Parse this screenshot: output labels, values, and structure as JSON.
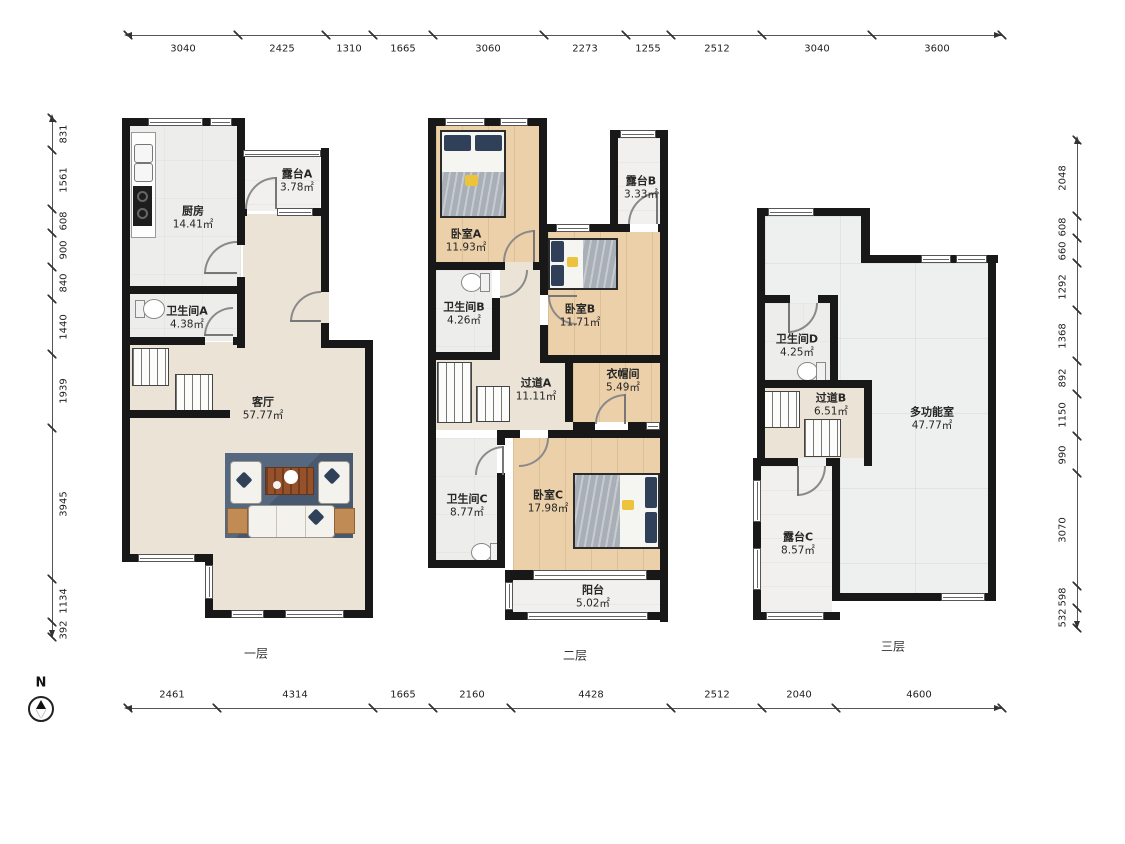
{
  "compass": {
    "north_label": "N"
  },
  "floors": [
    {
      "label": "一层",
      "rooms": [
        {
          "name": "厨房",
          "area": "14.41㎡"
        },
        {
          "name": "露台A",
          "area": "3.78㎡"
        },
        {
          "name": "卫生间A",
          "area": "4.38㎡"
        },
        {
          "name": "客厅",
          "area": "57.77㎡"
        }
      ]
    },
    {
      "label": "二层",
      "rooms": [
        {
          "name": "卧室A",
          "area": "11.93㎡"
        },
        {
          "name": "露台B",
          "area": "3.33㎡"
        },
        {
          "name": "卫生间B",
          "area": "4.26㎡"
        },
        {
          "name": "卧室B",
          "area": "11.71㎡"
        },
        {
          "name": "过道A",
          "area": "11.11㎡"
        },
        {
          "name": "衣帽间",
          "area": "5.49㎡"
        },
        {
          "name": "卫生间C",
          "area": "8.77㎡"
        },
        {
          "name": "卧室C",
          "area": "17.98㎡"
        },
        {
          "name": "阳台",
          "area": "5.02㎡"
        }
      ]
    },
    {
      "label": "三层",
      "rooms": [
        {
          "name": "卫生间D",
          "area": "4.25㎡"
        },
        {
          "name": "过道B",
          "area": "6.51㎡"
        },
        {
          "name": "多功能室",
          "area": "47.77㎡"
        },
        {
          "name": "露台C",
          "area": "8.57㎡"
        }
      ]
    }
  ],
  "dimensions": {
    "top": [
      "3040",
      "2425",
      "1310",
      "1665",
      "3060",
      "2273",
      "1255",
      "2512",
      "3040",
      "3600"
    ],
    "bottom": [
      "2461",
      "4314",
      "1665",
      "2160",
      "4428",
      "2512",
      "2040",
      "4600"
    ],
    "left": [
      "831",
      "1561",
      "608",
      "900",
      "840",
      "1440",
      "1939",
      "3945",
      "1134",
      "392"
    ],
    "right": [
      "2048",
      "608",
      "660",
      "1292",
      "1368",
      "892",
      "1150",
      "990",
      "3070",
      "598",
      "532"
    ]
  },
  "colors": {
    "wall": "#181818",
    "wood_floor": "#ebd0a9",
    "tile_floor": "#ededeb",
    "living_floor": "#eae3d6",
    "rug": "#4f6078",
    "pillow_navy": "#2f4058",
    "accent_yellow": "#ecc33d"
  }
}
